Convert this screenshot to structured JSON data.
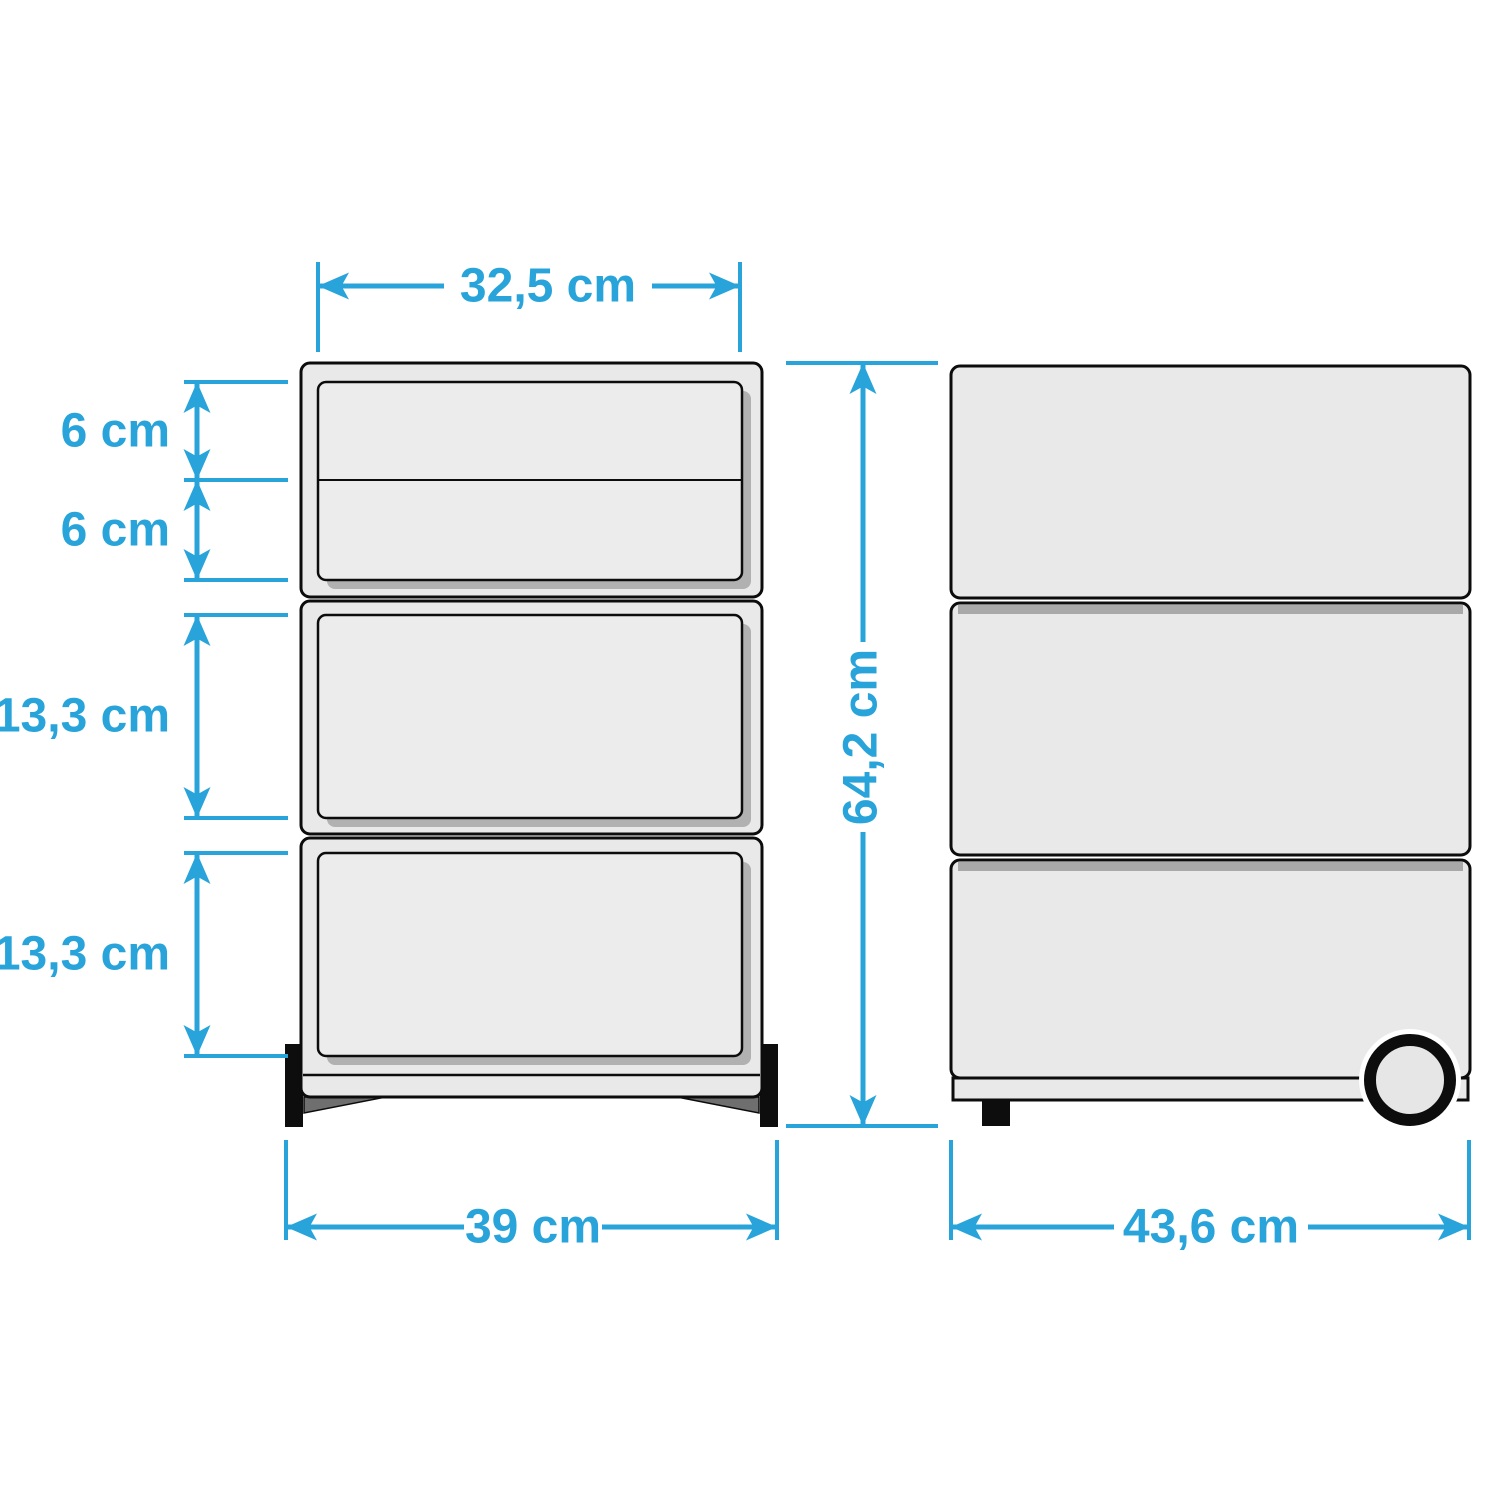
{
  "diagram_title": "drawer-cabinet-dimension-diagram",
  "dimensions": {
    "drawer_width": "32,5 cm",
    "top_drawer_1_height": "6 cm",
    "top_drawer_2_height": "6 cm",
    "middle_drawer_height": "13,3 cm",
    "bottom_drawer_height": "13,3 cm",
    "total_height": "64,2 cm",
    "total_width": "39 cm",
    "total_depth": "43,6 cm"
  },
  "colors": {
    "dimension": "#28a4da",
    "body_fill": "#e9e9e9",
    "drawer_fill": "#ececec",
    "shadow": "#b1b1b1",
    "separator": "#a9a9a9",
    "outline": "#0c0c0c",
    "feet": "#0d0d0d",
    "background": "#ffffff"
  }
}
